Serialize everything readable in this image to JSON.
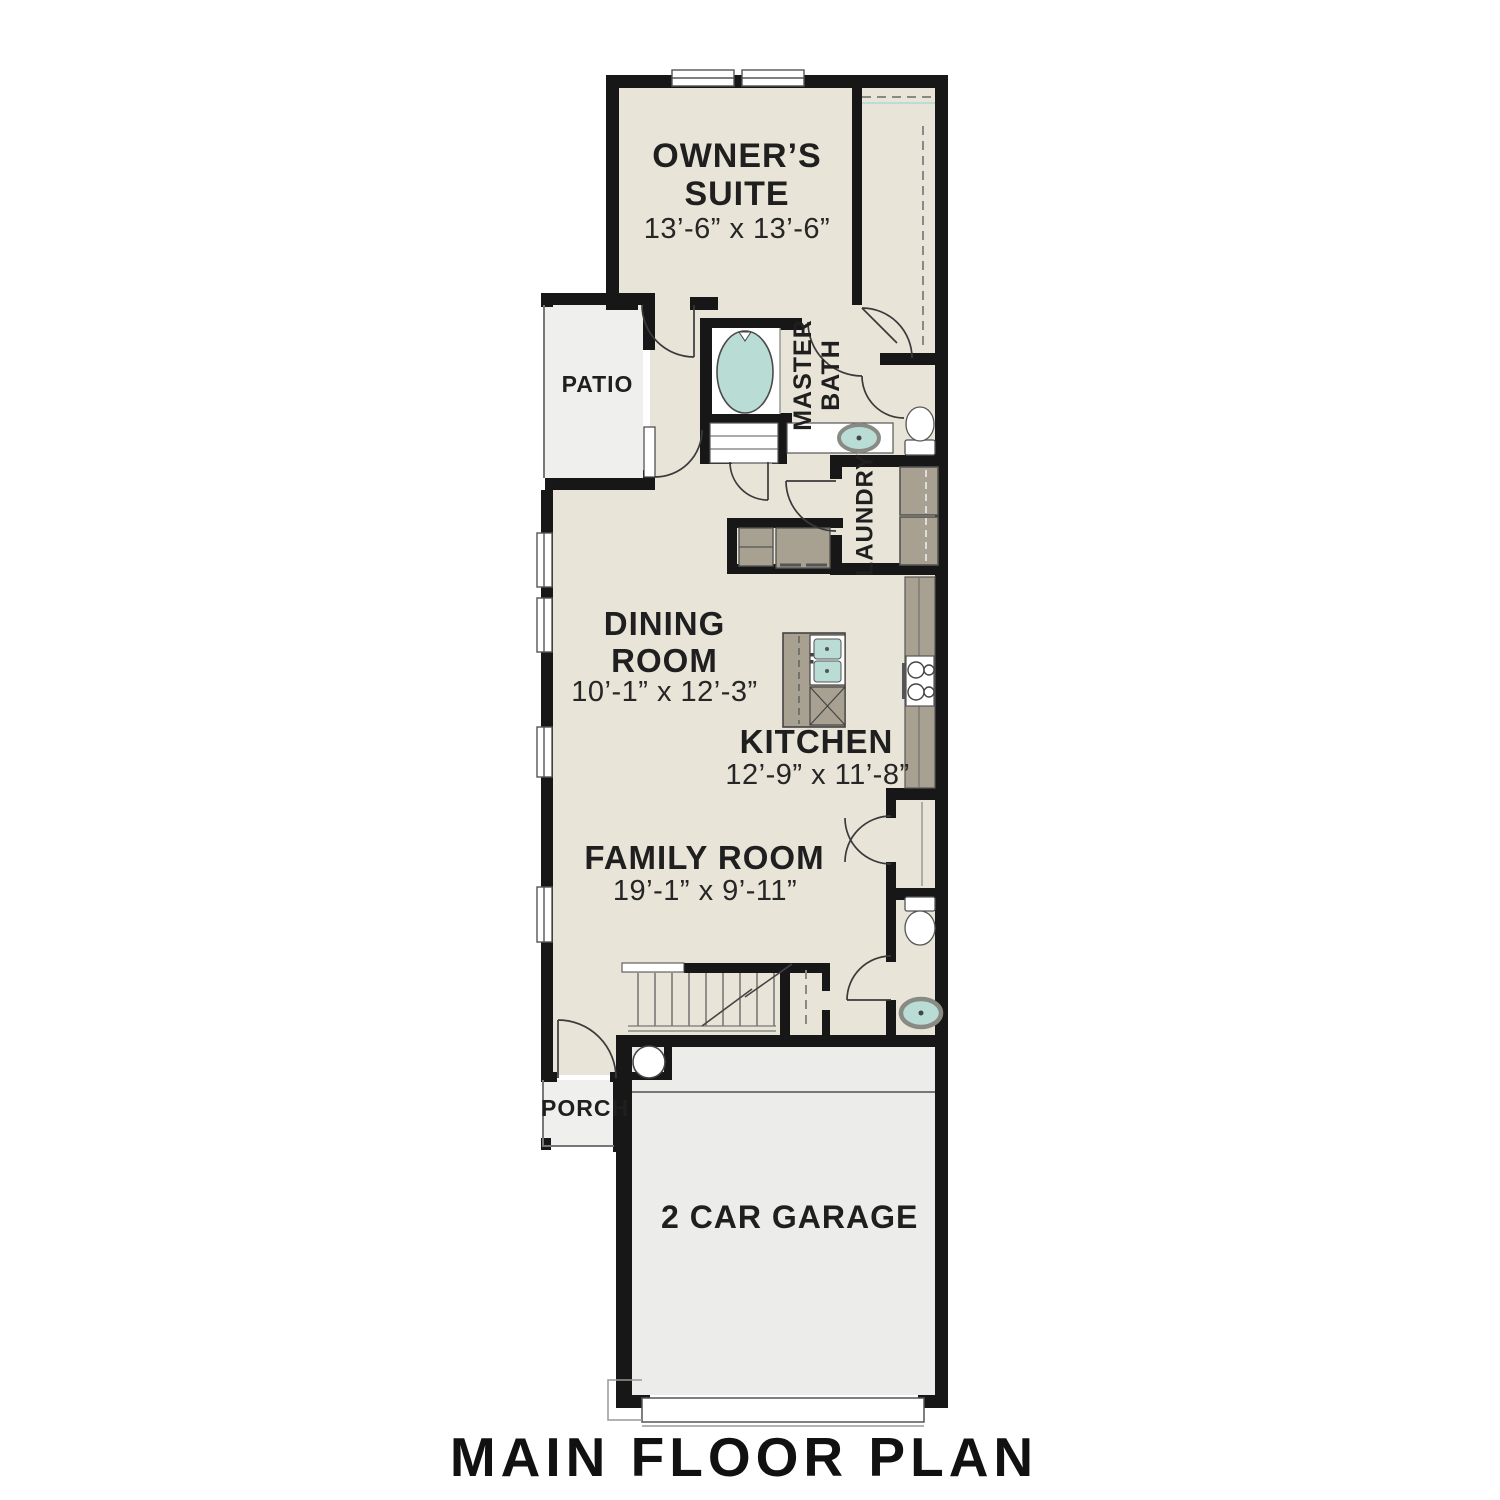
{
  "title": "MAIN FLOOR PLAN",
  "rooms": {
    "owners_suite": {
      "name": "OWNER’S SUITE",
      "dims": "13’-6” x 13’-6”"
    },
    "dining": {
      "name": "DINING ROOM",
      "dims": "10’-1” x 12’-3”"
    },
    "kitchen": {
      "name": "KITCHEN",
      "dims": "12’-9” x 11’-8”"
    },
    "family": {
      "name": "FAMILY ROOM",
      "dims": "19’-1” x 9’-11”"
    },
    "master_bath": {
      "name": "MASTER BATH"
    },
    "laundry": {
      "name": "LAUNDRY"
    },
    "patio": {
      "name": "PATIO"
    },
    "porch": {
      "name": "PORCH"
    },
    "garage": {
      "name": "2 CAR GARAGE"
    }
  },
  "colors": {
    "floor": "#e8e4d7",
    "outdoor": "#eeeeec",
    "garage": "#ececea",
    "wall": "#171717",
    "cabinet": "#a8a191",
    "water": "#b9dcd4"
  }
}
